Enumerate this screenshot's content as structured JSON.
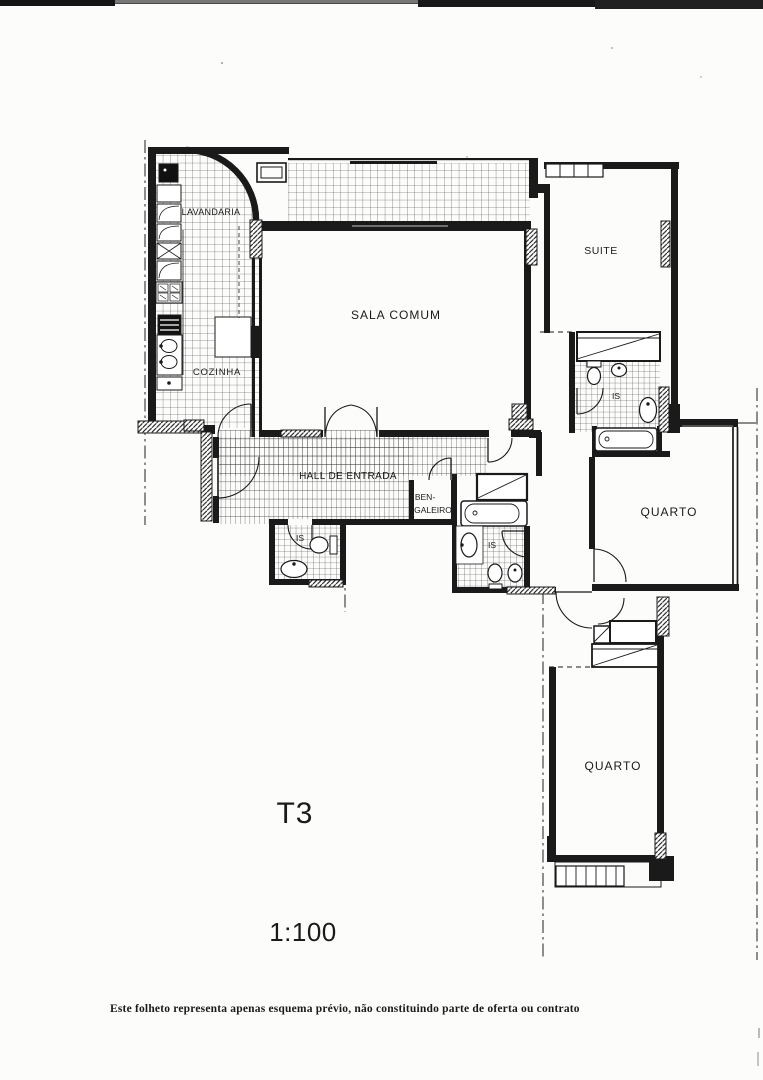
{
  "page": {
    "paper_color": "#fcfcfb",
    "ink_color": "#1a1a1a"
  },
  "plan": {
    "type_label": "T3",
    "scale_label": "1:100",
    "rooms": {
      "lavandaria": "LAVANDARIA",
      "cozinha": "COZINHA",
      "sala_comum": "SALA COMUM",
      "suite": "SUITE",
      "hall_entrada": "HALL DE ENTRADA",
      "bengaleiro_line1": "BEN-",
      "bengaleiro_line2": "GALEIRO",
      "is_hall": "IS",
      "is_suite": "IS",
      "is_corredor": "IS",
      "quarto_direito": "QUARTO",
      "quarto_inferior": "QUARTO"
    }
  },
  "footer": {
    "disclaimer": "Este folheto representa apenas esquema prévio, não constituindo parte de oferta ou contrato"
  }
}
